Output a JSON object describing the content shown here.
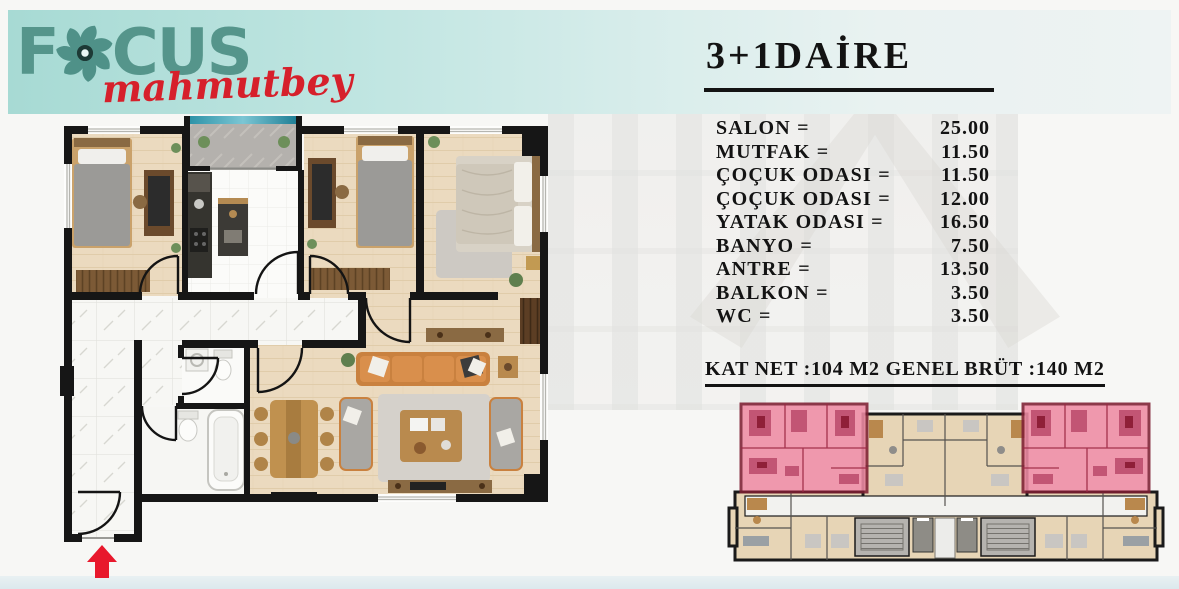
{
  "header": {
    "logo": {
      "part1": "F",
      "part2": "CUS",
      "script": "mahmutbey"
    }
  },
  "details": {
    "title": "3+1DAİRE",
    "rooms": [
      {
        "label": "SALON =",
        "value": "25.00"
      },
      {
        "label": "MUTFAK =",
        "value": "11.50"
      },
      {
        "label": "ÇOÇUK ODASI =",
        "value": "11.50"
      },
      {
        "label": "ÇOÇUK ODASI =",
        "value": "12.00"
      },
      {
        "label": "YATAK ODASI =",
        "value": "16.50"
      },
      {
        "label": "BANYO =",
        "value": "7.50"
      },
      {
        "label": "ANTRE =",
        "value": "13.50"
      },
      {
        "label": "BALKON =",
        "value": "3.50"
      },
      {
        "label": "WC =",
        "value": "3.50"
      }
    ],
    "summary": "KAT NET :104 M2 GENEL BRÜT :140 M2"
  },
  "icons": {
    "logo_mark": "pinwheel-icon",
    "entrance": "arrow-up-icon"
  },
  "colors": {
    "band_teal": "#a7dad4",
    "logo_teal": "#55958b",
    "logo_red": "#d6202b",
    "text_dark": "#131313",
    "highlight_pink": "#ef8ba4",
    "highlight_wall_red": "#7e1f33",
    "entrance_arrow_red": "#e8182c",
    "plan_wood": "#ebdabf",
    "plan_tile": "#f7f7f5",
    "balcony_glass_teal": "#2e93a8"
  }
}
